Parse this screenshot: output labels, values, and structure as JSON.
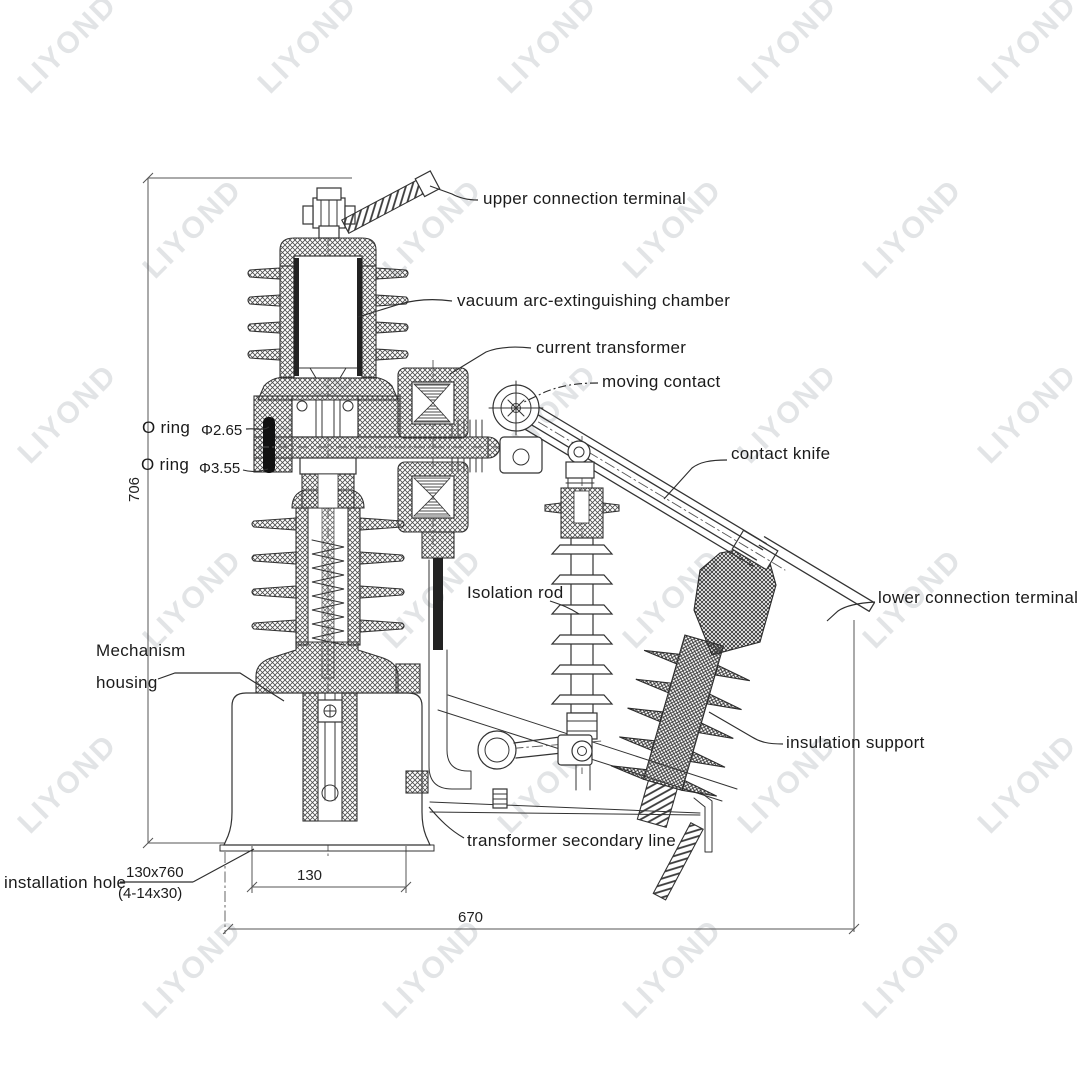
{
  "watermark": {
    "text": "LIYOND"
  },
  "callouts": {
    "upper_connection_terminal": "upper connection terminal",
    "vacuum_chamber": "vacuum arc-extinguishing chamber",
    "current_transformer": "current transformer",
    "moving_contact": "moving contact",
    "contact_knife": "contact knife",
    "lower_connection_terminal": "lower connection terminal",
    "isolation_rod": "Isolation rod",
    "insulation_support": "insulation support",
    "mechanism_housing_line1": "Mechanism",
    "mechanism_housing_line2": "housing",
    "transformer_secondary_line": "transformer secondary line",
    "installation_hole_label": "installation hole",
    "installation_hole_size": "130x760",
    "installation_hole_detail": "(4-14x30)",
    "o_ring_top_label": "O ring",
    "o_ring_top_value": "Φ2.65",
    "o_ring_bottom_label": "O ring",
    "o_ring_bottom_value": "Φ3.55"
  },
  "dimensions": {
    "overall_height": "706",
    "base_hole_spacing": "130",
    "overall_width": "670"
  }
}
